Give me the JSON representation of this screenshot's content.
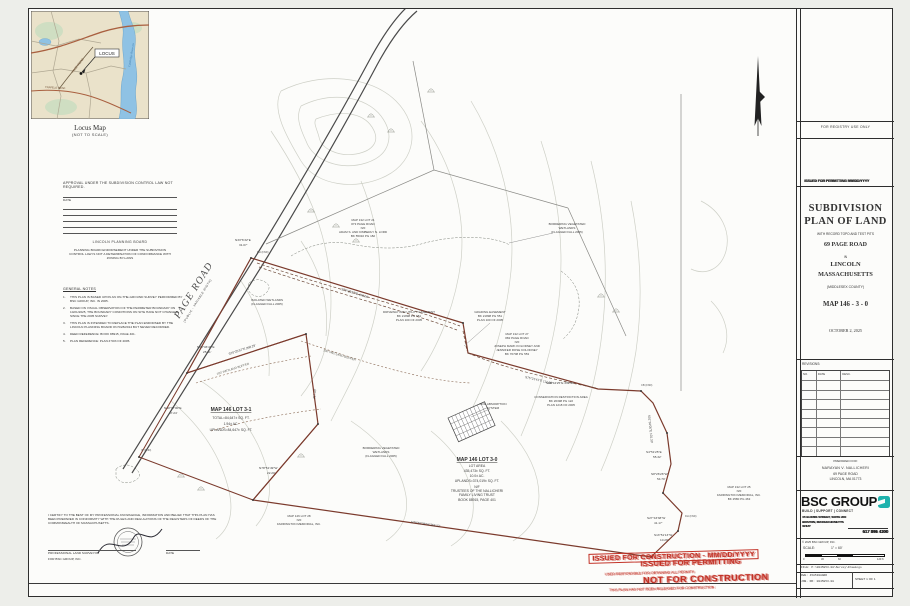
{
  "page": {
    "background": "#edeeea",
    "sheet_background": "#fcfcfa"
  },
  "locus": {
    "caption": "Locus Map",
    "subcaption": "(NOT TO SCALE)",
    "locus_label": "LOCUS",
    "road_label": "PAGE ROAD",
    "road2_label": "TRAPELO ROAD",
    "water_label": "Cambridge Reservoir"
  },
  "approval": {
    "heading": "APPROVAL UNDER THE SUBDIVISION CONTROL LAW NOT REQUIRED.",
    "date_label": "DATE",
    "board": "LINCOLN PLANNING BOARD",
    "endorsement": "PLANNING BOARD ENDORSEMENT UNDER THE SUBDIVISION CONTROL LAW IS NOT A DETERMINATION OF CONFORMANCE WITH ZONING BY-LAWS"
  },
  "notes": {
    "heading": "GENERAL NOTES",
    "items": [
      "THIS PLAN IS BASED UPON AN ON-THE-GROUND SURVEY PERFORMED BY BSC GROUP, INC. IN 2005.",
      "BASED ON VISUAL OBSERVATION OF THE PERIMETER BOUNDARY ON 10/21/2025, THE BOUNDARY CONDITIONS ON SITE HAVE NOT CHANGED SINCE THE 2005 SURVEY.",
      "THIS PLAN IS INTENDED TO REPLACE THE PLAN ENDORSED BY THE LINCOLN PLANNING BOARD ON 5/28/2014 BUT NEVER RECORDED.",
      "DEED REFERENCE: BOOK 88915, PAGE 401.",
      "PLAN REFERENCE: PLAN # 503 OF 2005."
    ]
  },
  "certification": {
    "text": "I CERTIFY TO THE BEST OF MY PROFESSIONAL KNOWLEDGE, INFORMATION AND BELIEF THAT THIS PLAN HAS BEEN PREPARED IN CONFORMITY WITH THE RULES AND REGULATIONS OF THE REGISTERS OF DEEDS OF THE COMMONWEALTH OF MASSACHUSETTS.",
    "surveyor_label": "PROFESSIONAL LAND SURVEYOR",
    "date_label": "DATE",
    "firm_label": "FOR BSC GROUP, INC."
  },
  "stamp": {
    "color": "#c23126",
    "box_line": "ISSUED FOR CONSTRUCTION - MM/DD/YYYY",
    "overlay_line": "ISSUED FOR PERMITTING",
    "not_line": "NOT FOR CONSTRUCTION",
    "small_line1": "USER RESPONSIBLE FOR OBTAINING ALL PERMITS",
    "small_line2": "THIS PLAN HAS NOT BEEN RELEASED FOR CONSTRUCTION"
  },
  "title_block": {
    "registry": "FOR REGISTRY USE ONLY",
    "overprint_line": "ISSUED FOR PERMITTING MM/DD/YYYY",
    "title_line1": "SUBDIVISION",
    "title_line2": "PLAN OF LAND",
    "subtitle": "WITH RECORD TOPO AND TEST PITS",
    "site_address": "69 PAGE ROAD",
    "in_label": "IN",
    "town": "LINCOLN",
    "state": "MASSACHUSETTS",
    "county": "(MIDDLESEX COUNTY)",
    "map_ref": "MAP 146 - 3 - 0",
    "plan_date": "OCTOBER 2, 2025",
    "revisions_label": "REVISIONS:",
    "rev_columns": [
      "NO.",
      "DATE",
      "DESC."
    ],
    "prepared_for_label": "PREPARED FOR:",
    "client_name": "NARAYAN V. NALLICHERI",
    "client_street": "69 PAGE ROAD",
    "client_city": "LINCOLN, MA 01773",
    "firm_name": "BSC GROUP",
    "firm_tagline": "BUILD | SUPPORT | CONNECT",
    "firm_address1": "15 ELKINS STREET, SUITE 200",
    "firm_address2": "BOSTON, MASSACHUSETTS",
    "firm_zip": "02127",
    "firm_phone": "617 896 4300",
    "copyright": "© 2025 BSC GROUP, INC.",
    "scale_label": "SCALE:",
    "scale_value": "1\" = 60'",
    "scale_ticks": [
      "0",
      "30",
      "60",
      "120 ft"
    ],
    "file_line": "FILE: P:\\0045853.08\\Survey\\Drawings",
    "dwg_line": "DWG: 4585308ANR",
    "job_line": "JOB. NO: 0045853.08",
    "sheet_label": "SHEET 1 OF 1",
    "accent": "#1fb3ad"
  },
  "plan": {
    "road_label": "PAGE ROAD",
    "road_sub": "(PUBLIC - VARIABLE WIDTH)",
    "buffer_label": "100' WETLAND BUFFER",
    "lot31": {
      "title": "MAP 146 LOT 3-1",
      "area1": "TOTAL=84,647± SQ. FT.",
      "area2": "1.94± AC.",
      "area3": "UPLANDS=84,647± SQ. FT."
    },
    "lot30": {
      "title": "MAP 146 LOT 3-0",
      "area_label": "LOT AREA",
      "area1": "435,473± SQ. FT.",
      "area2": "10.0± AC.",
      "area3": "UPLANDS=374,019± SQ. FT.",
      "nf": "N/F",
      "owner1": "TRUSTEES OF THE NALLICHERI",
      "owner2": "FAMILY LIVING TRUST",
      "book": "BOOK 88915, PAGE 401"
    },
    "bearings": [
      "S70°25'57\"E   498.06'",
      "S70°25'57\"E   268.29'",
      "N38°46'43\"E",
      "25.31'",
      "N33°6'32\"E",
      "31.07'",
      "N30°37'00\"E",
      "47.24'",
      "S89°44'25\"E   339.91'",
      "S01°33'05\"E   101.33'",
      "S4°51'25\"E",
      "55.32'",
      "S8°26'26\"W",
      "54.70'",
      "S27°43'38\"W",
      "41.17'",
      "S13°51'13\"W",
      "10.28'",
      "N78°52'38\"W   363.12'",
      "S75°21'41\"E   112.08'",
      "N78°51'49\"W",
      "22.20'",
      "217.10'"
    ],
    "labels": {
      "lot21": [
        "MAP 132 LOT 21",
        "#73 PAGE ROAD",
        "N/F",
        "ADAM S. AND KIMBERLY N. LORD",
        "BK 55010 PG 182"
      ],
      "kolodney": [
        "MAP 132 LOT 27",
        "#82 PAGE ROAD",
        "N/F",
        "JOSEPH MARK KOLODNEY AND",
        "JENNIFER ROSE KOLODNEY",
        "BK 76708 PG 553"
      ],
      "conservation": [
        "CONSERVATION RESTRICTION AREA",
        "BK 26398 PG 122",
        "PLAN 1218 OF 2005"
      ],
      "grading": [
        "GRADING EASEMENT",
        "BK 21898 PG 551",
        "PLAN 100 OF 2005"
      ],
      "driveway": [
        "DRIVEWAY AND UTILITY EASEMENT",
        "BK 21898 PG 551",
        "PLAN 100 OF 2005"
      ],
      "farrington_e": [
        "MAP 132 LOT 25",
        "N/F",
        "FARRINGTON MEMORIAL, INC.",
        "BK 2580 PG 463"
      ],
      "farrington_s": [
        "MAP 146 LOT 28",
        "N/F",
        "FARRINGTON MEMORIAL, INC."
      ],
      "bvw1": [
        "BORDERING VEGETATED",
        "WETLANDS",
        "(FLAGGED FALL 2005)"
      ],
      "bvw2": [
        "BORDERING VEGETATED",
        "WETLANDS",
        "(FLAGGED FALL 2005)"
      ],
      "isolated": [
        "ISOLATED WETLANDS",
        "(FLAGGED FALL 2005)"
      ],
      "soil": [
        "SOIL ABSORPTION",
        "SYSTEM"
      ]
    },
    "monuments": [
      "DH (FND)",
      "CB (FND)",
      "DH (FND)",
      "IP (FND)"
    ]
  }
}
